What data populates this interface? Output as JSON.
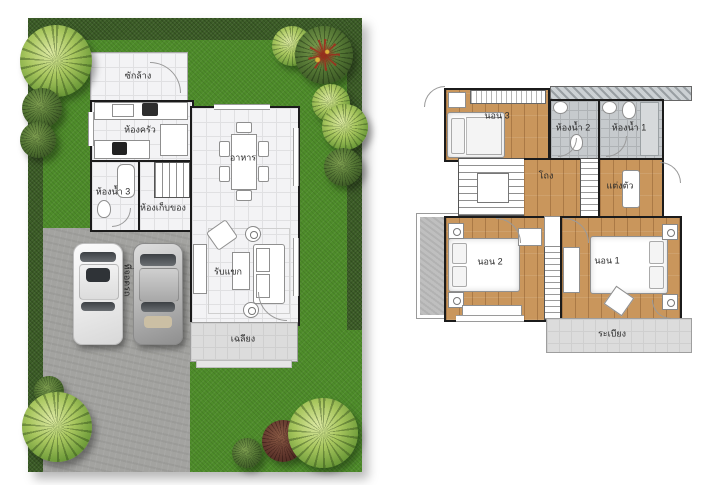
{
  "floor1": {
    "laundry": "ซักล้าง",
    "kitchen": "ห้องครัว",
    "bath3": "ห้องน้ำ 3",
    "storage": "ห้องเก็บของ",
    "dining": "อาหาร",
    "living": "รับแขก",
    "porch": "เฉลียง",
    "parking": "ที่จอดรถ"
  },
  "floor2": {
    "bed3": "นอน 3",
    "bath2": "ห้องน้ำ 2",
    "bath1": "ห้องน้ำ 1",
    "hall": "โถง",
    "dressing": "แต่งตัว",
    "bed2": "นอน 2",
    "bed1": "นอน 1",
    "balcony": "ระเบียง"
  },
  "colors": {
    "lawn": "#4e8c2a",
    "hedge": "#3b5c26",
    "drive": "#a3a3a0",
    "tile": "#f3f3f5",
    "wood": "#c9965c",
    "bath": "#c6cacd",
    "porch": "#dcdcdc",
    "wall": "#1b1b1b"
  }
}
